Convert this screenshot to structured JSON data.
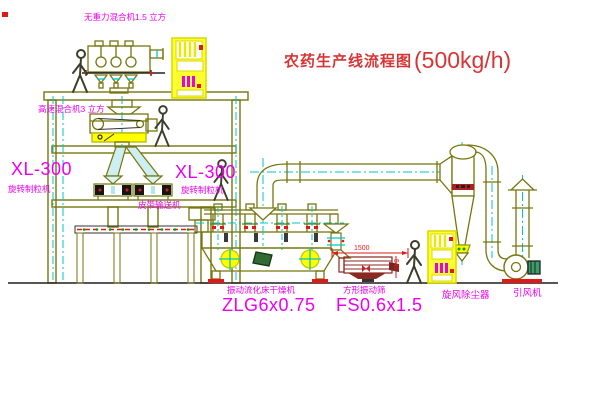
{
  "title": {
    "name": "农药生产线流程图",
    "capacity": "(500kg/h)"
  },
  "labels": {
    "gravity_free_mixer": "无重力混合机1.5 立方",
    "high_speed_mixer": "高速混合机3 立方",
    "granulator_left_model": "XL-300",
    "granulator_left_name": "旋转制粒机",
    "granulator_mid_model": "XL-300",
    "granulator_mid_name": "旋转制粒机",
    "belt_conveyor": "皮带输送机",
    "fluid_bed_dryer": "振动流化床干燥机",
    "fluid_bed_dryer_model": "ZLG6x0.75",
    "vibrating_screen": "方形振动筛",
    "vibrating_screen_model": "FS0.6x1.5",
    "cyclone": "旋风除尘器",
    "induced_draft_fan": "引风机"
  },
  "dimensions": {
    "screen_length": "1500",
    "screen_height": "545"
  },
  "colors": {
    "label_magenta": "#ee00ee",
    "title_red": "#d93535",
    "line_olive": "#76760e",
    "centerline_cyan": "#00c7c7",
    "cabinet_yellow": "#ffff2e",
    "accent_red": "#e01818"
  }
}
